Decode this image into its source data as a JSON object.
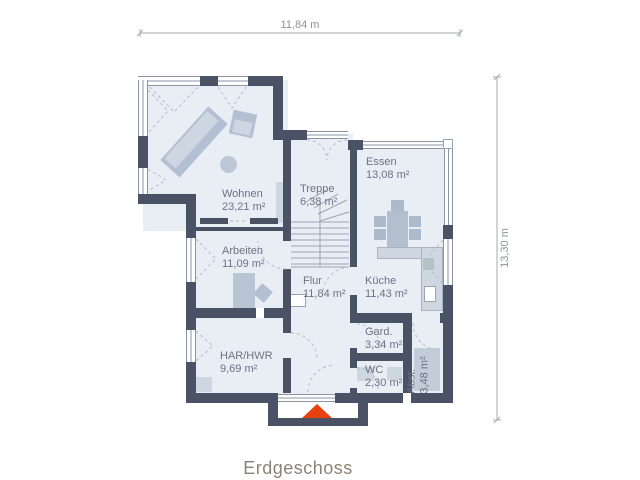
{
  "title": "Erdgeschoss",
  "dimensions": {
    "width_label": "11,84 m",
    "height_label": "13,30 m"
  },
  "rooms": [
    {
      "id": "wohnen",
      "name": "Wohnen",
      "area": "23,21 m²"
    },
    {
      "id": "treppe",
      "name": "Treppe",
      "area": "6,38 m²"
    },
    {
      "id": "essen",
      "name": "Essen",
      "area": "13,08 m²"
    },
    {
      "id": "arbeiten",
      "name": "Arbeiten",
      "area": "11,09 m²"
    },
    {
      "id": "flur",
      "name": "Flur",
      "area": "11,84 m²"
    },
    {
      "id": "kueche",
      "name": "Küche",
      "area": "11,43 m²"
    },
    {
      "id": "har-hwr",
      "name": "HAR/HWR",
      "area": "9,69 m²"
    },
    {
      "id": "gard",
      "name": "Gard.",
      "area": "3,34 m²"
    },
    {
      "id": "wc",
      "name": "WC",
      "area": "2,30 m²"
    },
    {
      "id": "abst",
      "name": "Abst.",
      "area": "3,48 m²"
    }
  ],
  "colors": {
    "wall": "#4a5266",
    "floor": "#e9eef5",
    "furniture": "#b3c0d3",
    "furniture_light": "#cdd6e1",
    "entry_arrow": "#e8400e",
    "room_label": "#6d7282",
    "dimension": "#8d929b",
    "title": "#8c8274"
  }
}
